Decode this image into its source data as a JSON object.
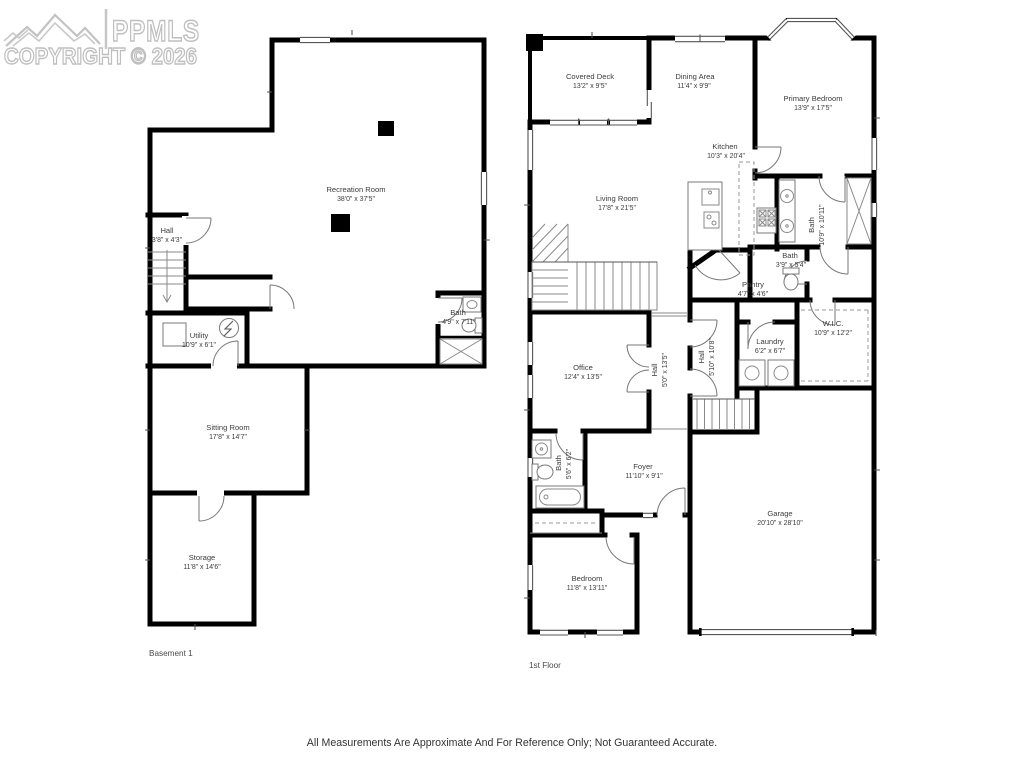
{
  "watermark": {
    "brand": "PPMLS",
    "copyright": "COPYRIGHT © 2026",
    "logo": "mountain-logo"
  },
  "disclaimer": "All Measurements Are Approximate And For Reference Only; Not Guaranteed Accurate.",
  "floors": [
    {
      "label": "Basement 1",
      "rooms": [
        {
          "name": "Recreation Room",
          "dims": "38'0\" x 37'5\""
        },
        {
          "name": "Hall",
          "dims": "3'8\" x 4'3\""
        },
        {
          "name": "Utility",
          "dims": "10'9\" x 6'1\""
        },
        {
          "name": "Bath",
          "dims": "4'9\" x 7'11\""
        },
        {
          "name": "Sitting Room",
          "dims": "17'8\" x 14'7\""
        },
        {
          "name": "Storage",
          "dims": "11'8\" x 14'6\""
        }
      ]
    },
    {
      "label": "1st Floor",
      "rooms": [
        {
          "name": "Covered Deck",
          "dims": "13'2\" x 9'5\""
        },
        {
          "name": "Dining Area",
          "dims": "11'4\" x 9'9\""
        },
        {
          "name": "Primary Bedroom",
          "dims": "13'9\" x 17'5\""
        },
        {
          "name": "Kitchen",
          "dims": "10'3\" x 20'4\""
        },
        {
          "name": "Living Room",
          "dims": "17'8\" x 21'5\""
        },
        {
          "name": "Bath",
          "dims": "10'9\" x 10'11\""
        },
        {
          "name": "Bath",
          "dims": "3'9\" x 5'4\""
        },
        {
          "name": "Pantry",
          "dims": "4'7\" x 4'6\""
        },
        {
          "name": "W.I.C.",
          "dims": "10'9\" x 12'2\""
        },
        {
          "name": "Laundry",
          "dims": "6'2\" x 6'7\""
        },
        {
          "name": "Hall",
          "dims": "5'10\" x 10'8\""
        },
        {
          "name": "Office",
          "dims": "12'4\" x 13'5\""
        },
        {
          "name": "Hall",
          "dims": "5'0\" x 13'5\""
        },
        {
          "name": "Bath",
          "dims": "5'6\" x 6'2\""
        },
        {
          "name": "Foyer",
          "dims": "11'10\" x 9'1\""
        },
        {
          "name": "Garage",
          "dims": "20'10\" x 28'10\""
        },
        {
          "name": "Bedroom",
          "dims": "11'8\" x 13'11\""
        }
      ]
    }
  ]
}
